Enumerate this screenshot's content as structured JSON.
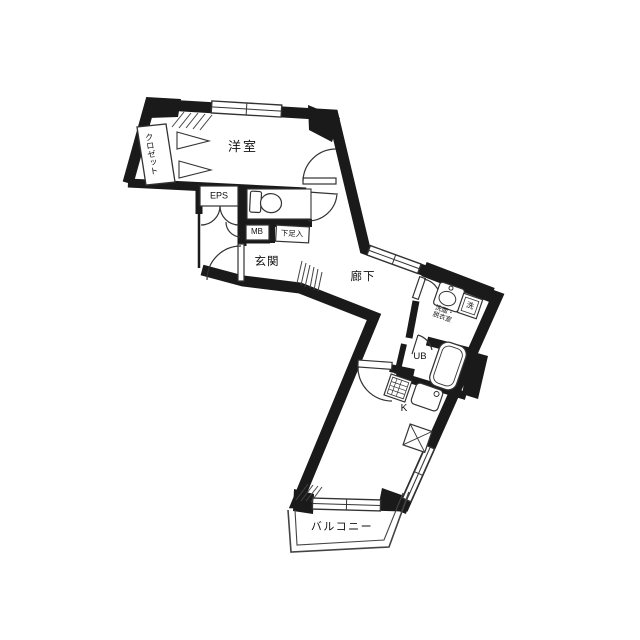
{
  "floorplan": {
    "labels": {
      "western_room": "洋室",
      "closet": "クロゼット",
      "eps": "EPS",
      "meter_box": "MB",
      "shoe_box": "下足入",
      "entrance": "玄関",
      "hallway": "廊下",
      "washroom": "洗面・\n脱衣室",
      "unit_bath": "UB",
      "washer_mark": "洗",
      "kitchen": "K",
      "balcony": "バルコニー"
    },
    "colors": {
      "wall": "#1a1a1a",
      "line": "#333333",
      "background": "#ffffff"
    }
  }
}
